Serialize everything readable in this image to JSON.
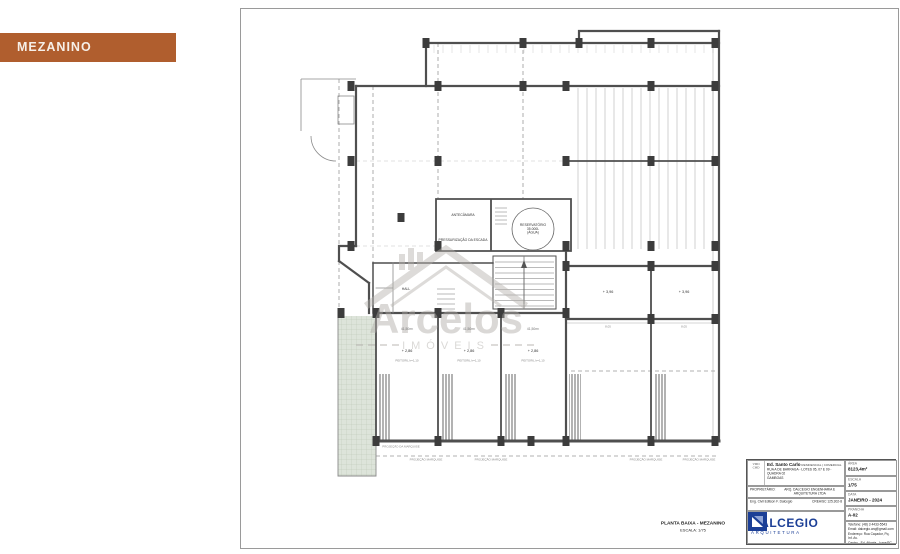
{
  "tag": {
    "label": "MEZANINO"
  },
  "plan_labels": {
    "antecamara": "ANTECÂMARA",
    "pressurizacao": "PRESSURIZAÇÃO DA ESCADA",
    "reservatorio1": "RESERVATÓRIO",
    "reservatorio2": "35.000L",
    "reservatorio3": "(ÁGUA)",
    "hall": "HALL",
    "area_unit": "41,50m²",
    "level_mezanino": "+ 2,86",
    "peitoril": "PEITORIL h=1,10",
    "level_right": "+ 3,96",
    "dim_right": "8,05",
    "marquise": "PROJEÇÃO MARQUISE",
    "marquise_left": "PROJEÇÃO DA MARQUISE"
  },
  "watermark": {
    "name": "Arcelos",
    "subtitle": "IMÓVEIS"
  },
  "caption": {
    "line1": "PLANTA BAIXA - MEZANINO",
    "line2": "ESCALA: 1/75"
  },
  "titleblock": {
    "monogram_top": "VMD",
    "monogram_bottom": "CMD",
    "project_name": "Ed. Santo Carlo",
    "project_type": "RESIDENCIAL | COMERCIAL",
    "address1": "RUA A DE BARRAGA - LOTES 05, 07 E 09 - QUADRA 02",
    "address2": "GAMBOAS",
    "owner_label": "PROPRIETÁRIO:",
    "responsible1": "ARQ. DALCEGIO ENGENHARIA E ARQUITETURA LTDA",
    "responsible2_left": "Eng. Civil Edilson F. Dalcegio",
    "responsible2_right": "CREA/SC 125.302-8",
    "fields": {
      "area": {
        "label": "ÁREA",
        "value": "8123,4m²"
      },
      "escala": {
        "label": "ESCALA",
        "value": "1/75"
      },
      "data": {
        "label": "DATA",
        "value": "JANEIRO - 2024"
      },
      "prancha": {
        "label": "PRANCHA",
        "value": "A-02"
      }
    },
    "brand": {
      "name": "DALCEGIO",
      "subtitle": "ARQUITETURA",
      "contact1": "Telefone: (48) 3 4433-5543",
      "contact2": "Email: dalcegio.arq@gmail.com",
      "contact3": "Endereço: Rua Caçador, Pq. Inf. Av.",
      "contact4": "Centro - Ed. Atlanta - Içara/SC"
    }
  }
}
